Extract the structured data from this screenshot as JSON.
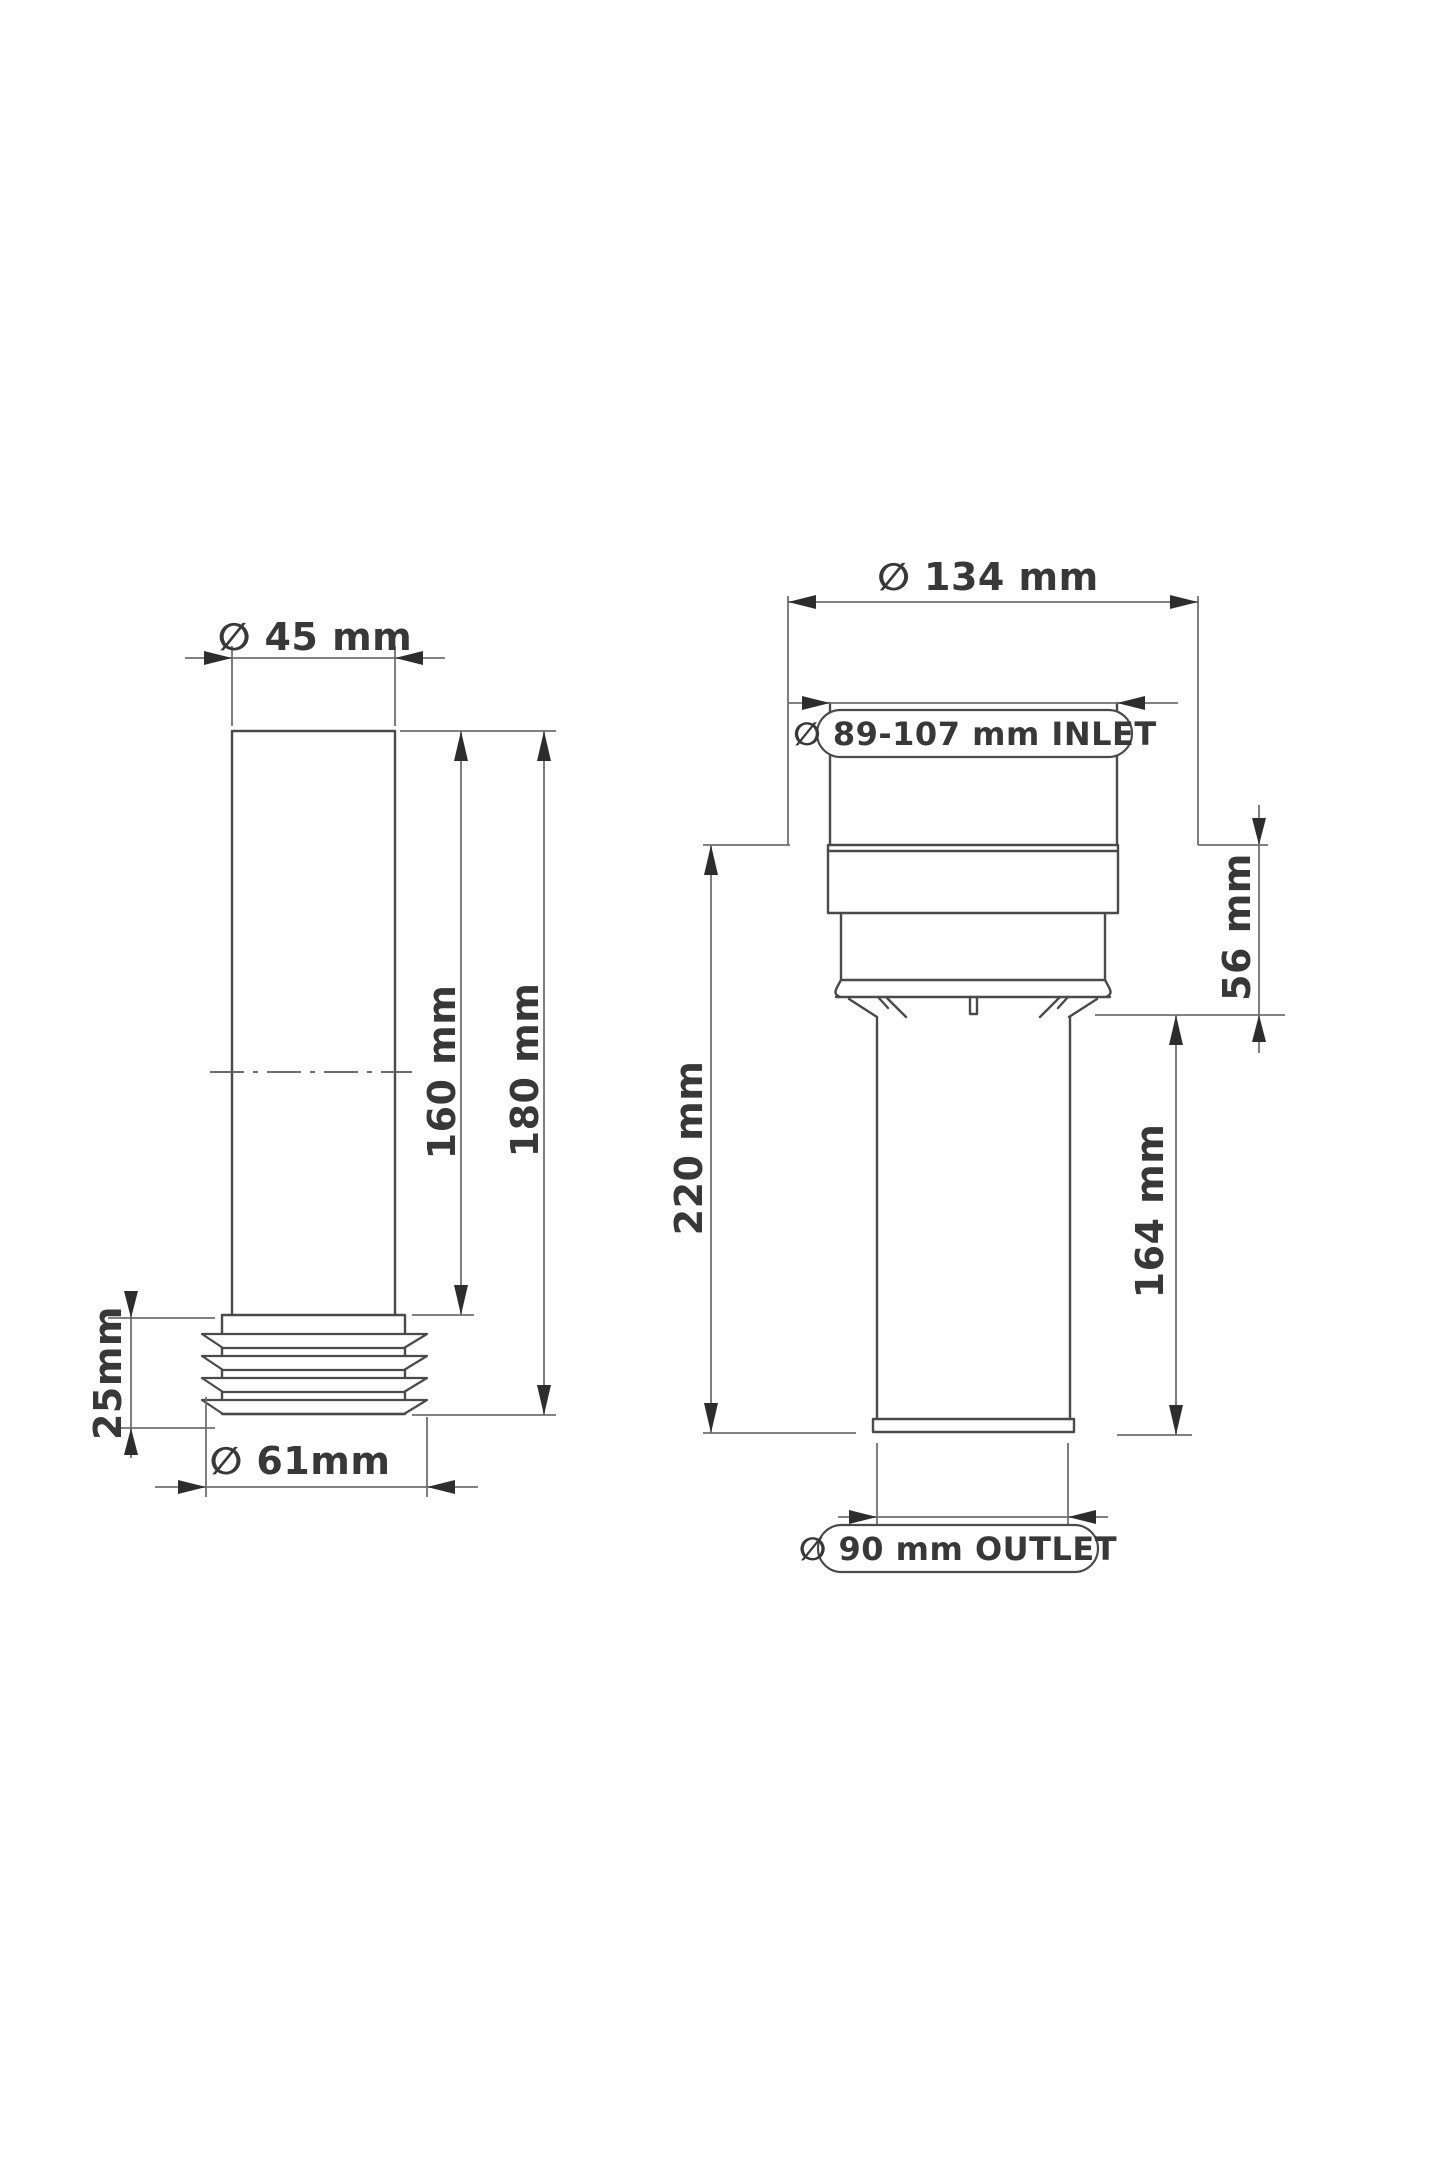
{
  "page": {
    "background": "#ffffff",
    "object_line_color": "#4a4a4a",
    "dimension_line_color": "#707070",
    "text_color": "#383838"
  },
  "left_view": {
    "name": "flush pipe side view with sealing gasket",
    "dimensions": {
      "top_diameter": "∅ 45 mm",
      "pipe_length": "160 mm",
      "overall_length": "180 mm",
      "gasket_height": "25mm",
      "gasket_diameter": "∅ 61mm"
    }
  },
  "right_view": {
    "name": "WC pan connector front view",
    "dimensions": {
      "flange_diameter": "∅ 134 mm",
      "inlet_label": "∅ 89-107 mm INLET",
      "socket_height": "56 mm",
      "overall_height": "220 mm",
      "outlet_length": "164 mm",
      "outlet_label": "∅ 90 mm OUTLET"
    }
  }
}
